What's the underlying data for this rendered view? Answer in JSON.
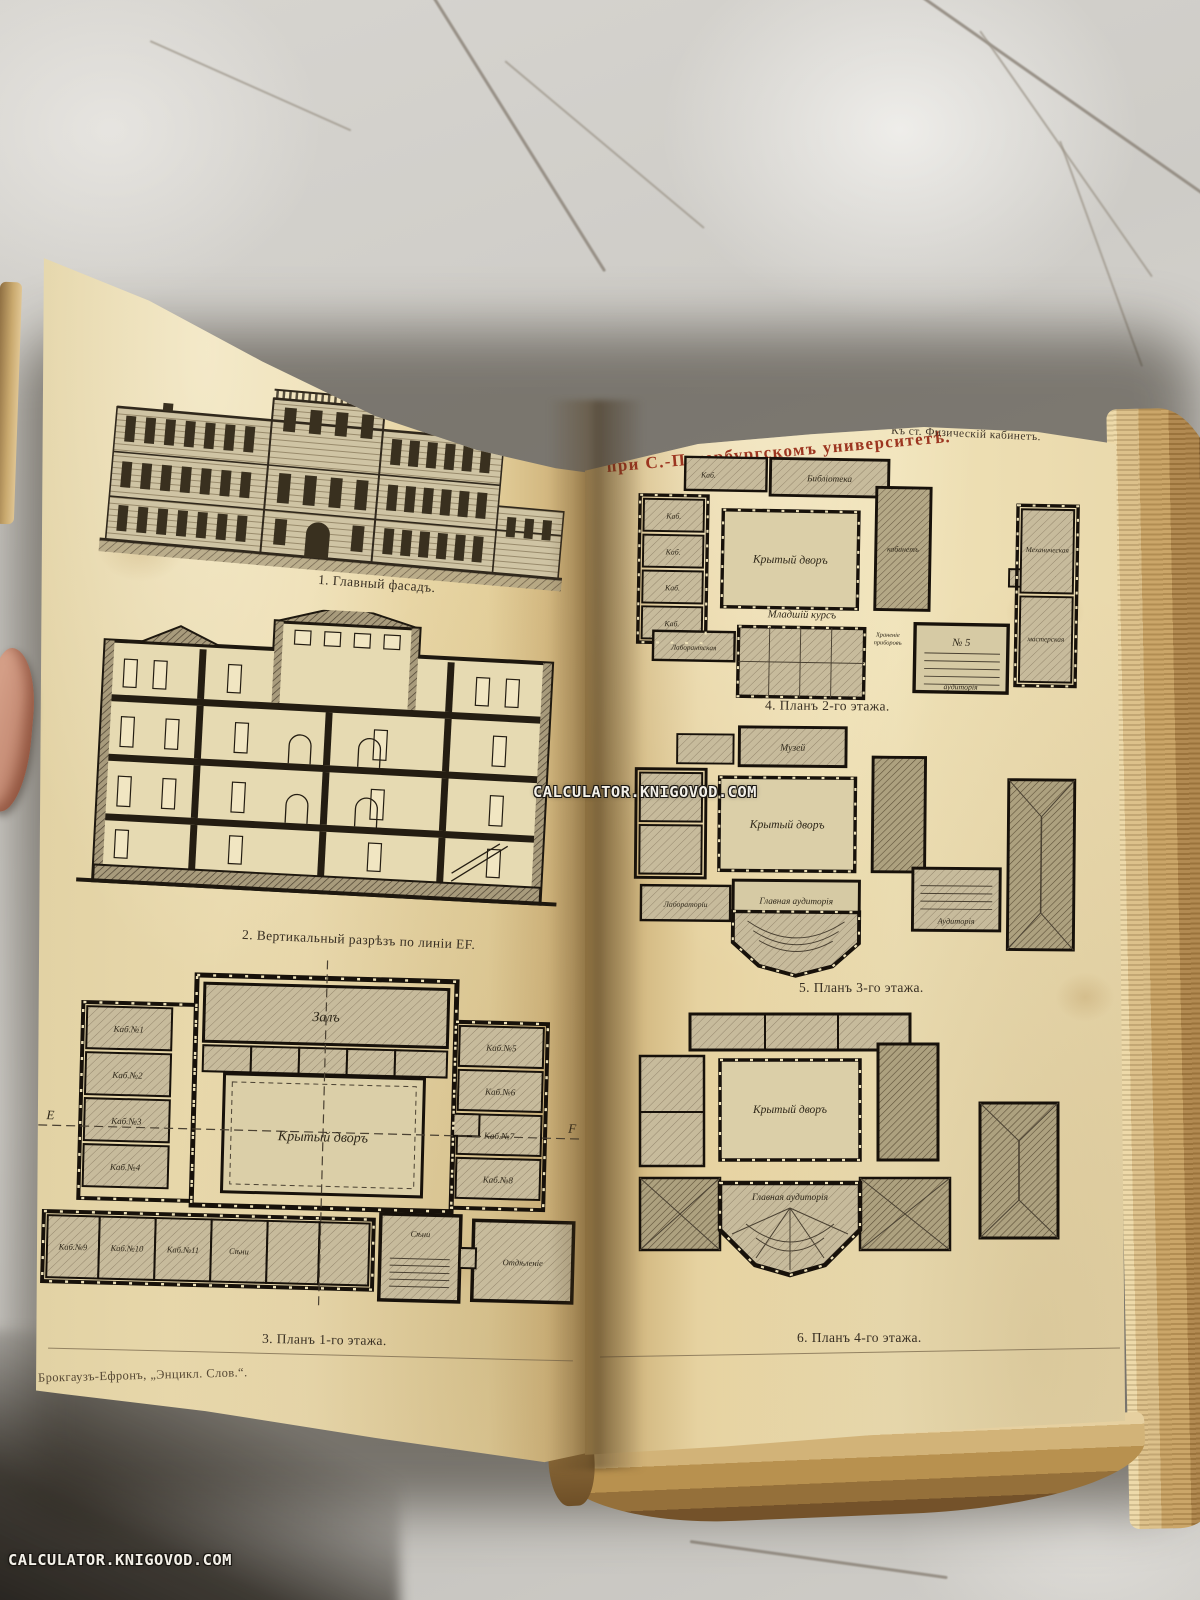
{
  "photo": {
    "watermark_center": "CALCULATOR.KNIGOVOD.COM",
    "watermark_corner": "CALCULATOR.KNIGOVOD.COM"
  },
  "book": {
    "title_left": "ФИЗИЧЕСКІЙ ИНСТИТУТЪ",
    "title_right": "при С.-Петербургскомъ университетѣ.",
    "header_note": "Къ ст. Физическій кабинетъ.",
    "imprint": "Брокгаузъ-Ефронъ, „Энцикл. Слов.“.",
    "figures": {
      "fig1": {
        "caption": "1. Главный фасадъ."
      },
      "fig2": {
        "caption": "2. Вертикальный разрѣзъ по линіи EF."
      },
      "fig3": {
        "caption": "3. Планъ 1-го этажа.",
        "labels": {
          "hall": "Залъ",
          "courtyard": "Крытый дворъ",
          "kab1": "Каб.№1",
          "kab2": "Каб.№2",
          "kab3": "Каб.№3",
          "kab4": "Каб.№4",
          "kab5": "Каб.№5",
          "kab6": "Каб.№6",
          "kab7": "Каб.№7",
          "kab8": "Каб.№8",
          "kab9": "Каб.№9",
          "kab10": "Каб.№10",
          "kab11": "Каб.№11",
          "seni": "Сѣни",
          "otdelenie": "Отдѣленіе",
          "pt_e": "E",
          "pt_f": "F"
        }
      },
      "fig4": {
        "caption": "4. Планъ 2-го этажа.",
        "labels": {
          "library": "Библіотека",
          "kab": "Каб.",
          "courtyard": "Крытый дворъ",
          "junior": "Младшій курсъ",
          "aud5_no": "№ 5",
          "aud5": "аудиторія",
          "mech1": "Механическая",
          "mech2": "мастерская",
          "lab": "Лаборантская",
          "storage1": "Храненіе",
          "storage2": "приборовъ",
          "cabinet": "кабинетъ"
        }
      },
      "fig5": {
        "caption": "5. Планъ 3-го этажа.",
        "labels": {
          "museum": "Музей",
          "courtyard": "Крытый дворъ",
          "labs": "Лабораторіи",
          "main_aud": "Главная аудиторія",
          "aud": "Аудиторія"
        }
      },
      "fig6": {
        "caption": "6. Планъ 4-го этажа.",
        "labels": {
          "courtyard": "Крытый дворъ",
          "main_aud": "Главная аудиторія"
        }
      }
    }
  }
}
